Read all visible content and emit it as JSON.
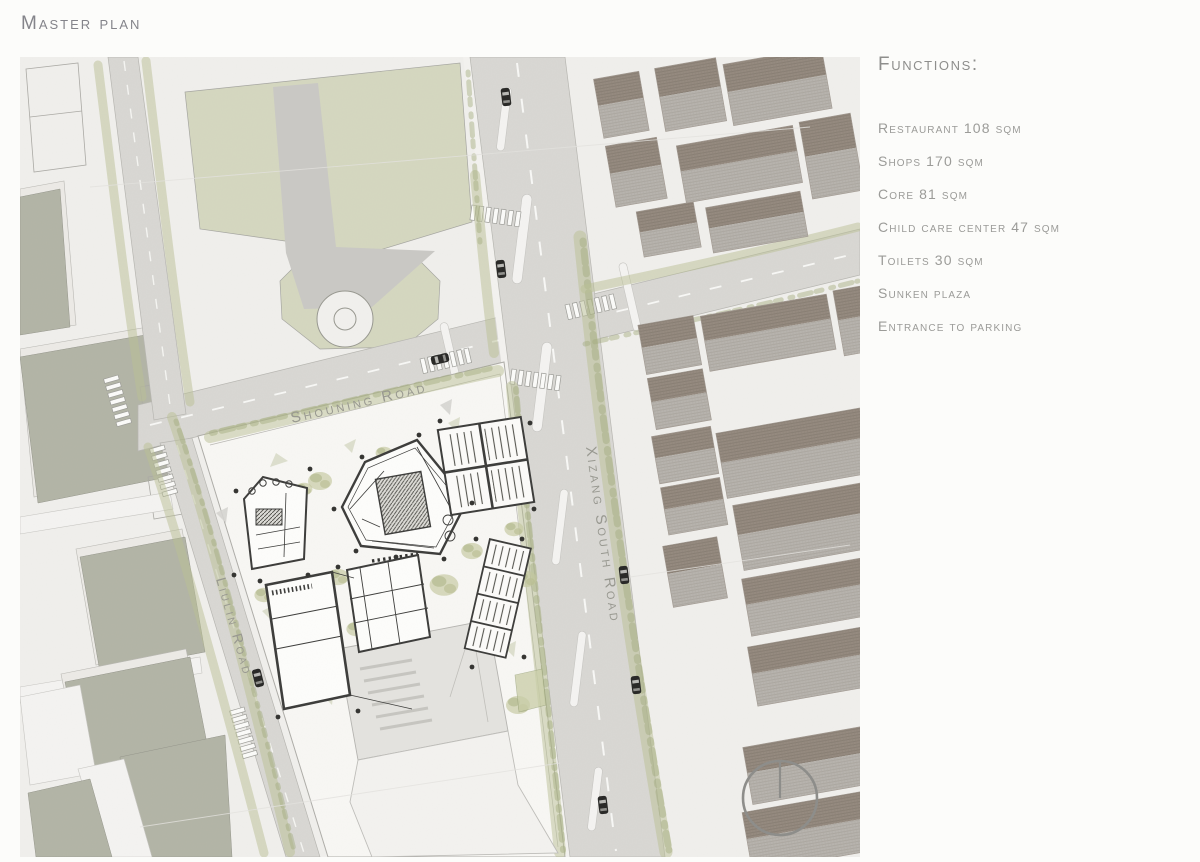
{
  "page": {
    "title": "Master plan"
  },
  "functions": {
    "heading": "Functions:",
    "items": [
      "Restaurant 108 sqm",
      "Shops 170 sqm",
      "Core 81 sqm",
      "Child care center 47 sqm",
      "Toilets 30 sqm",
      "Sunken plaza",
      "Entrance to parking"
    ]
  },
  "plan": {
    "roads": [
      {
        "name": "Shouning Road"
      },
      {
        "name": "Xizang South Road"
      },
      {
        "name": "Liulin Road"
      }
    ],
    "compass": {
      "type": "north-indicator"
    },
    "colors": {
      "paper": "#f0efec",
      "park_green": "#d4d7bf",
      "road_gray": "#d8d7d3",
      "roof_dark": "#94897e",
      "roof_light": "#b7b3ad",
      "plan_line": "#3b3b39",
      "text_gray": "#9b9b98"
    }
  }
}
